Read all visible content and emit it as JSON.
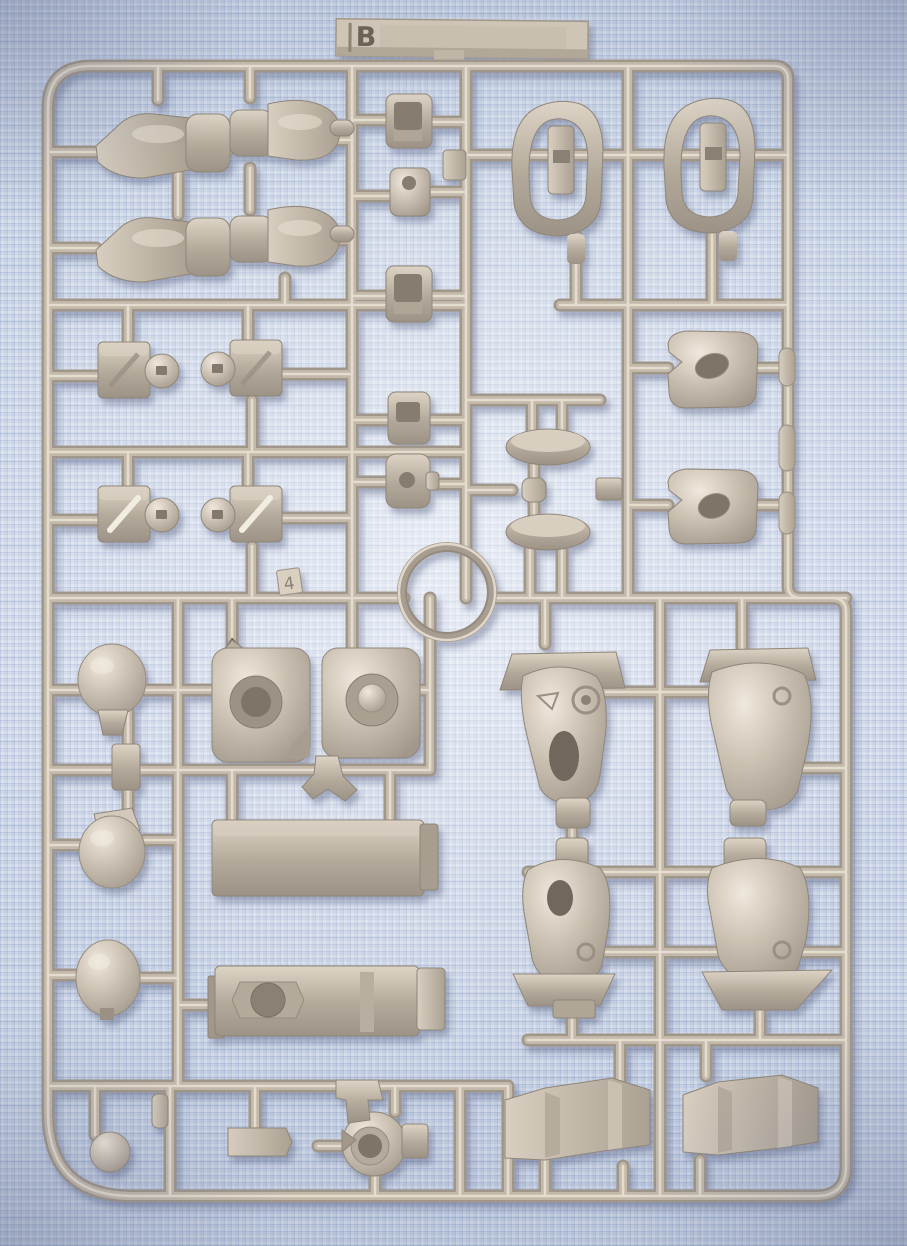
{
  "photo": {
    "description": "Beige plastic model-kit sprue (runner) holding unassembled robot-model parts, photographed on a light blue waffle-weave cloth",
    "sprue": {
      "tab_label": "B",
      "molded_part_number": "4",
      "plastic_color": "#c4baac",
      "plastic_highlight": "#e8e0d2",
      "plastic_shadow": "#968c7f"
    },
    "background": {
      "cloth_color": "#ccd7e7",
      "texture": "waffle-weave",
      "vignette_color": "#5c6585"
    }
  }
}
